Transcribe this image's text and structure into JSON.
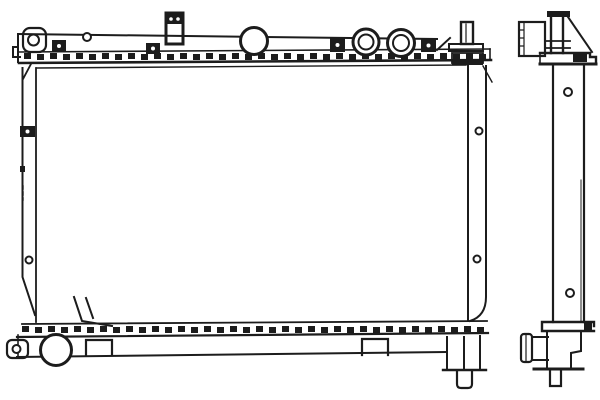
{
  "page": {
    "background": "#ffffff",
    "ink": "#1c1c1c"
  },
  "figure": {
    "type": "technical-line-drawing",
    "subject": "automotive radiator parts diagram, front elevation and side profile",
    "views": [
      {
        "id": "front-view",
        "label": "radiator front elevation"
      },
      {
        "id": "side-view",
        "label": "radiator side profile"
      }
    ],
    "front_parts": [
      "top-tank",
      "radiator-cap",
      "inlet-port-ring",
      "inlet-port-ring",
      "upper-mount-bracket",
      "top-right-bracket",
      "crimped-top-header",
      "core",
      "left-side-plate",
      "right-side-plate",
      "bottom-tank",
      "crimped-bottom-header",
      "drain-boss",
      "bottom-left-end-cap",
      "bottom-mount-bracket",
      "bottom-mount-bracket",
      "bottom-right-pin"
    ],
    "side_parts": [
      "side-upper-bracket",
      "filler-neck",
      "side-top-flange",
      "side-core-column",
      "side-lower-tank",
      "outlet-pipe",
      "side-bottom-pin"
    ]
  },
  "drawing": {
    "crimp_rows": [
      {
        "name": "top-header-crimp",
        "x": 24,
        "y": 53,
        "count": 36,
        "step": 13,
        "w": 7,
        "h": 6
      },
      {
        "name": "bottom-header-crimp",
        "x": 22,
        "y": 326,
        "count": 36,
        "step": 13,
        "w": 7,
        "h": 6
      }
    ],
    "holes": [
      {
        "cx": 87,
        "cy": 37,
        "r": 4
      },
      {
        "cx": 29,
        "cy": 260,
        "r": 3.5
      },
      {
        "cx": 479,
        "cy": 131,
        "r": 3.5
      },
      {
        "cx": 477,
        "cy": 259,
        "r": 3.5
      },
      {
        "cx": 568,
        "cy": 92,
        "r": 4
      },
      {
        "cx": 570,
        "cy": 293,
        "r": 4
      },
      {
        "cx": 33.5,
        "cy": 40,
        "r": 5.5
      },
      {
        "cx": 16.5,
        "cy": 349,
        "r": 4
      }
    ],
    "clips": [
      {
        "x": 52,
        "y": 40,
        "w": 14,
        "h": 12
      },
      {
        "x": 146,
        "y": 43,
        "w": 14,
        "h": 11
      },
      {
        "x": 330,
        "y": 38,
        "w": 15,
        "h": 14
      },
      {
        "x": 421,
        "y": 39,
        "w": 15,
        "h": 13
      },
      {
        "x": 20,
        "y": 126,
        "w": 15,
        "h": 11
      }
    ],
    "ports": [
      {
        "name": "radiator-cap",
        "layer": "top-ports",
        "cx": 254,
        "cy": 41,
        "r": 13.5,
        "inner": null
      },
      {
        "name": "inlet-port-ring",
        "layer": "top-ports",
        "cx": 366,
        "cy": 42,
        "r": 13,
        "inner": 7.5
      },
      {
        "name": "inlet-port-ring",
        "layer": "top-ports",
        "cx": 401,
        "cy": 43,
        "r": 13.5,
        "inner": 8
      },
      {
        "name": "drain-boss",
        "layer": "bottom-ports",
        "cx": 56,
        "cy": 350,
        "r": 15.5,
        "inner": null
      }
    ]
  }
}
